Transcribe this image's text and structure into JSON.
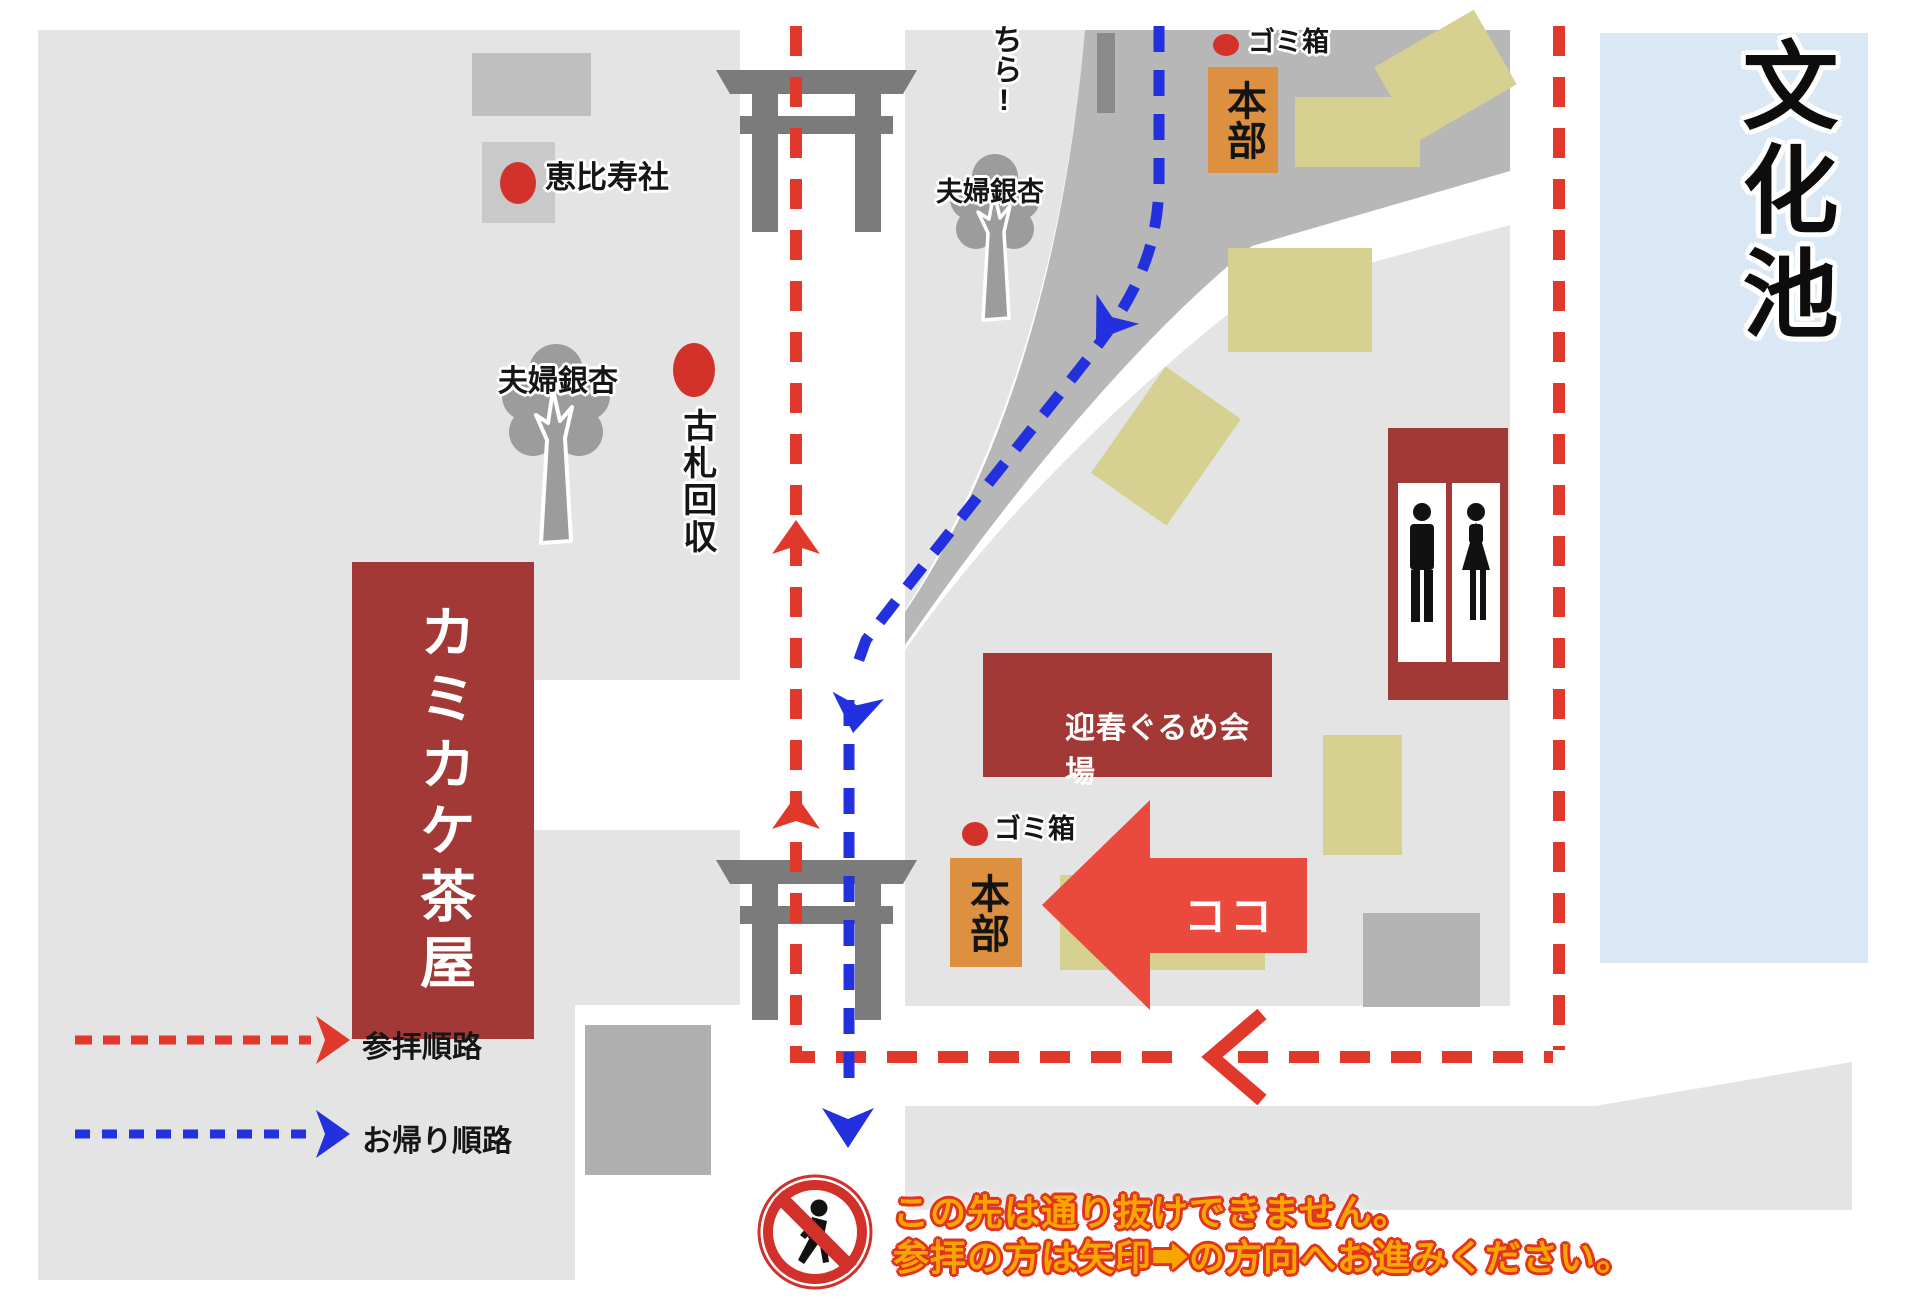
{
  "pond": {
    "label": "文化池"
  },
  "partial_route_text": "ちら!",
  "spots": {
    "ebisu": "恵比寿社",
    "ginkgo_west": "夫婦銀杏",
    "ginkgo_north": "夫婦銀杏",
    "old_talisman": "古札回収",
    "trash_north": "ゴミ箱",
    "trash_center": "ゴミ箱",
    "hq_north": "本部",
    "hq_center": "本部",
    "teahouse": "カミカケ茶屋",
    "gourmet_hall": "迎春ぐるめ会場",
    "here": "ココ"
  },
  "legend": {
    "visit_route": "参拝順路",
    "return_route": "お帰り順路"
  },
  "warning": {
    "line1": "この先は通り抜けできません。",
    "line2": "参拝の方は矢印➡の方向へお進みください。"
  },
  "colors": {
    "ground": "#e4e4e4",
    "road": "#b7b7b7",
    "dark_red_building": "#a23936",
    "orange_hq": "#dd9140",
    "route_red": "#e0392b",
    "route_blue": "#2231dd",
    "tent_beige": "#d6d091",
    "pond_blue": "#d9e8f4",
    "warning_yellow": "#f7a600",
    "marker_red": "#d3322a"
  }
}
